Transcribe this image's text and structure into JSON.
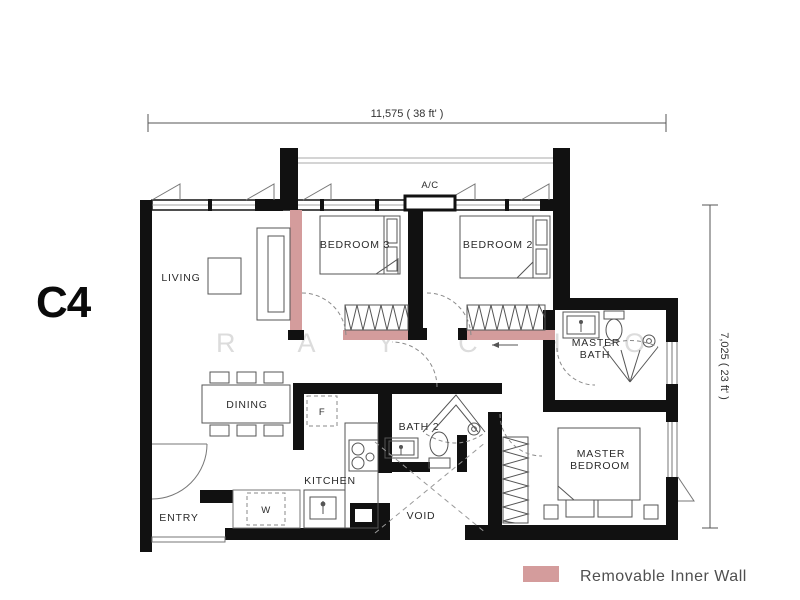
{
  "unit_label": "C4",
  "dimensions": {
    "top": "11,575 ( 38 ft' )",
    "right": "7,025 ( 23 ft' )"
  },
  "labels": {
    "living": "LIVING",
    "dining": "DINING",
    "entry": "ENTRY",
    "kitchen": "KITCHEN",
    "bedroom3": "BEDROOM 3",
    "bedroom2": "BEDROOM 2",
    "bath2": "BATH 2",
    "void": "VOID",
    "master_bath": [
      "MASTER",
      "BATH"
    ],
    "master_bedroom": [
      "MASTER",
      "BEDROOM"
    ],
    "ac": "A/C",
    "fridge": "F",
    "washer": "W"
  },
  "legend": {
    "label": "Removable Inner Wall",
    "swatch_color": "#d49c9c"
  },
  "watermark": "R A Y   C H O",
  "colors": {
    "wall": "#111111",
    "removable_wall": "#d49c9c"
  }
}
